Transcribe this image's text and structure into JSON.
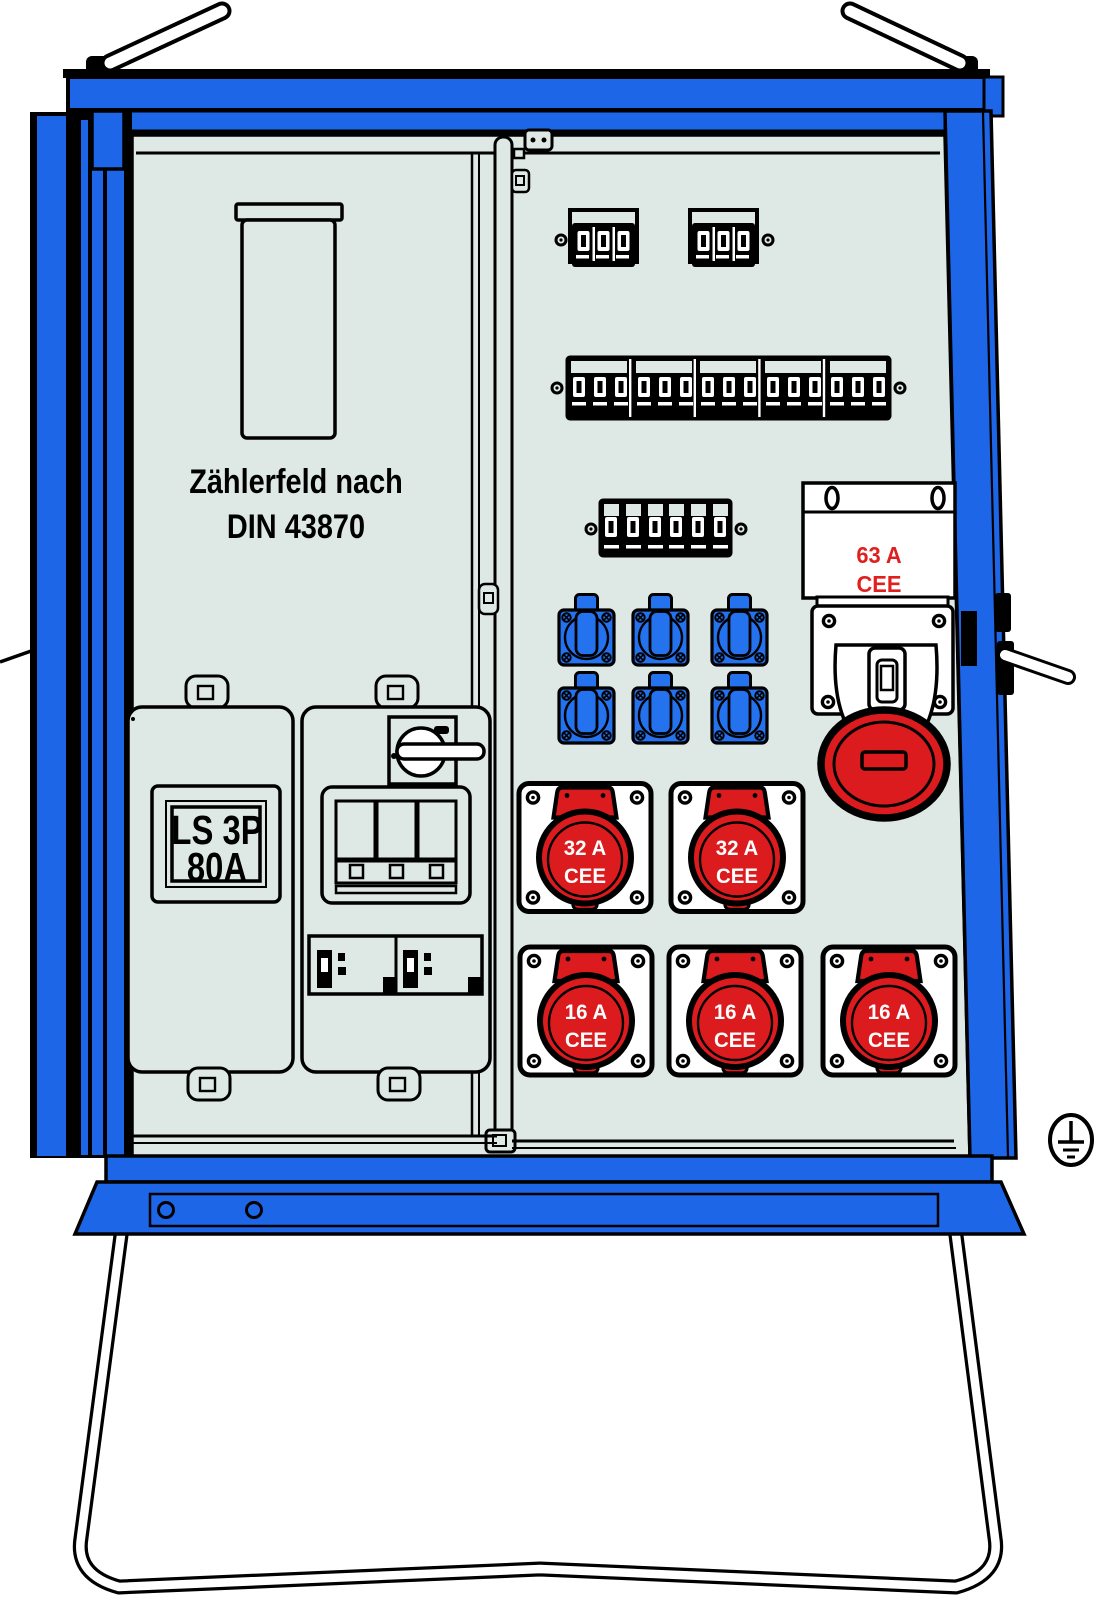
{
  "meter_panel": {
    "line1": "Zählerfeld nach",
    "line2": "DIN 43870"
  },
  "main_breaker": {
    "line1": "LS 3P",
    "line2": "80A"
  },
  "cee63": {
    "line1": "63 A",
    "line2": "CEE"
  },
  "cee32_1": {
    "line1": "32 A",
    "line2": "CEE"
  },
  "cee32_2": {
    "line1": "32 A",
    "line2": "CEE"
  },
  "cee16_1": {
    "line1": "16 A",
    "line2": "CEE"
  },
  "cee16_2": {
    "line1": "16 A",
    "line2": "CEE"
  },
  "cee16_3": {
    "line1": "16 A",
    "line2": "CEE"
  },
  "colors": {
    "cabinet_blue": "#1D66E8",
    "socket_blue": "#2472EE",
    "cee_red": "#DC1B1E",
    "label_red": "#E0201E",
    "panel_bg": "#DEE9E5",
    "outline": "#000000"
  }
}
